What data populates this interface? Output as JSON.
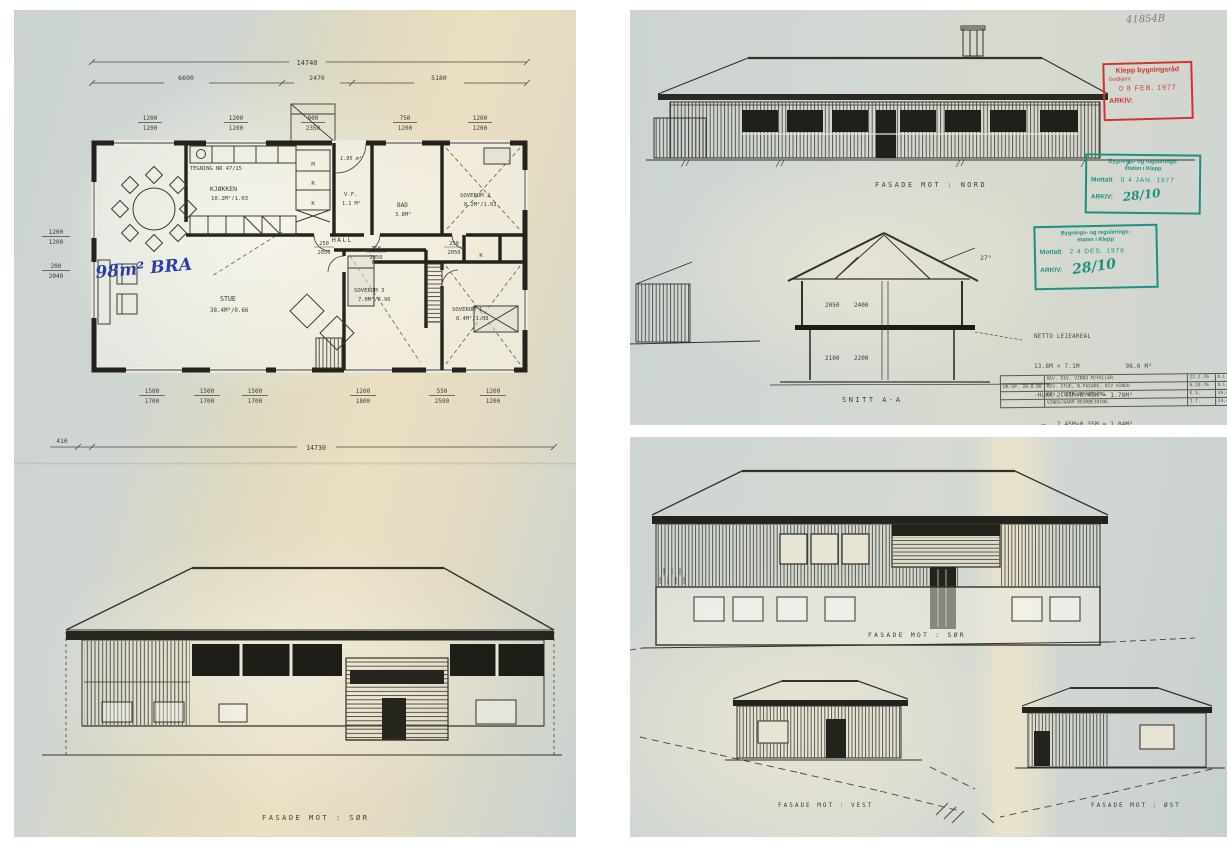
{
  "colors": {
    "paper_blue": "#ccd4d1",
    "paper_cream": "#eadfc2",
    "ink": "#3e3c32",
    "stamp_red": "#cf362b",
    "stamp_green": "#1c9183",
    "pen_blue": "#2b3fa6"
  },
  "left": {
    "dims": {
      "total_top": "14740",
      "seg1": "6690",
      "seg2": "2470",
      "seg3": "5180",
      "total_bottom": "14730",
      "offset_left": "410"
    },
    "win_top": [
      {
        "a": "1200",
        "b": "1200"
      },
      {
        "a": "1200",
        "b": "1200"
      },
      {
        "a": "900",
        "b": "2350"
      },
      {
        "a": "750",
        "b": "1200"
      },
      {
        "a": "1200",
        "b": "1200"
      }
    ],
    "win_left": [
      {
        "a": "1200",
        "b": "1200"
      },
      {
        "a": "200",
        "b": "2040"
      }
    ],
    "win_bottom": [
      {
        "a": "1500",
        "b": "1700"
      },
      {
        "a": "1500",
        "b": "1700"
      },
      {
        "a": "1500",
        "b": "1700"
      },
      {
        "a": "1200",
        "b": "1800"
      },
      {
        "a": "550",
        "b": "2590"
      },
      {
        "a": "1200",
        "b": "1200"
      }
    ],
    "dims_inner": [
      {
        "a": "250",
        "b": "2050"
      },
      {
        "a": "750",
        "b": "2050"
      },
      {
        "a": "250",
        "b": "2050"
      }
    ],
    "rooms": {
      "note": "TEGNING NR 47/15",
      "kjokken": "KJØKKEN",
      "kjokken_area": "10.2M²/1.03",
      "stue": "STUE",
      "stue_area": "38.4M²/0.66",
      "hall": "HALL",
      "bad": "BAD",
      "bad_area": "3.8M²",
      "sov1": "SOVEROM 1",
      "sov1_area": "8.4M²/1.03",
      "sov2": "SOVEROM 2",
      "sov2_area": "8.2M²/1.03",
      "sov3": "SOVEROM 3",
      "sov3_area": "7.0M²/0.96",
      "vf": "V.F.",
      "vf_area": "1.1 M²",
      "wc_area": "1.95 m²",
      "m": "M",
      "r": "R",
      "k": "K",
      "k2": "K"
    },
    "handwritten_area": "98m² BRA",
    "facade_label": "FASADE MOT : SØR"
  },
  "tr": {
    "sheet_no": "41854B",
    "facade_label": "FASADE MOT : NORD",
    "snitt_label": "SNITT A-A",
    "angle": "27°",
    "h_upper_a": "2050",
    "h_upper_b": "2400",
    "h_lower_a": "2100",
    "h_lower_b": "2200",
    "stamp_red": {
      "l1": "Klepp bygningsråd",
      "l2": "Godkjent",
      "date": "0 8 FEB. 1977",
      "arkiv": "ARKIV:"
    },
    "stamp_g1": {
      "org1": "Bygnings- og regulerings-",
      "org2": "etaten i Klepp",
      "mottatt": "Mottatt",
      "date": "0 4 JAN. 1977",
      "arkiv": "ARKIV:",
      "nr": "28/10"
    },
    "stamp_g2": {
      "org1": "Bygnings- og regulerings-",
      "org2": "etaten i Klepp",
      "mottatt": "Mottatt",
      "date": "2 4 DES. 1976",
      "arkiv": "ARKIV:",
      "nr": "28/10"
    },
    "calc": {
      "l0": "NETTO LEIEAREAL",
      "l1": "13.8M × 7.1M            98.0 M²",
      "l2": "-HUKK 2.45M×0.45M = 1.78M²",
      "l3": "  —   2.45M×0.35M = 1.04M²",
      "l4": "-VF   1.4M×1.2M  = 1.68M²  4.5 M²",
      "l5": "                        93.5 M²"
    },
    "rev": {
      "rows": [
        {
          "c0": "",
          "c1": "REV. DIV. VINDU M/FELLER",
          "c2": "22.2.76",
          "c3": "O.L"
        },
        {
          "c0": "GR.SP. 20.8.80",
          "c1": "REV. STUE, N.FASADE, DIV VINDU",
          "c2": "6.10.76",
          "c3": "O.L"
        },
        {
          "c0": "",
          "c1": "REV. ETTER BEHANDLING",
          "c2": "E.S.",
          "c3": "19.4.77"
        },
        {
          "c0": "",
          "c1": "VINDU/KARM BEARBEIDING",
          "c2": "I.T.",
          "c3": "24.4.77"
        }
      ]
    }
  },
  "br": {
    "facade_sor": "FASADE MOT : SØR",
    "facade_vest": "FASADE MOT : VEST",
    "facade_ost": "FASADE MOT : ØST"
  }
}
